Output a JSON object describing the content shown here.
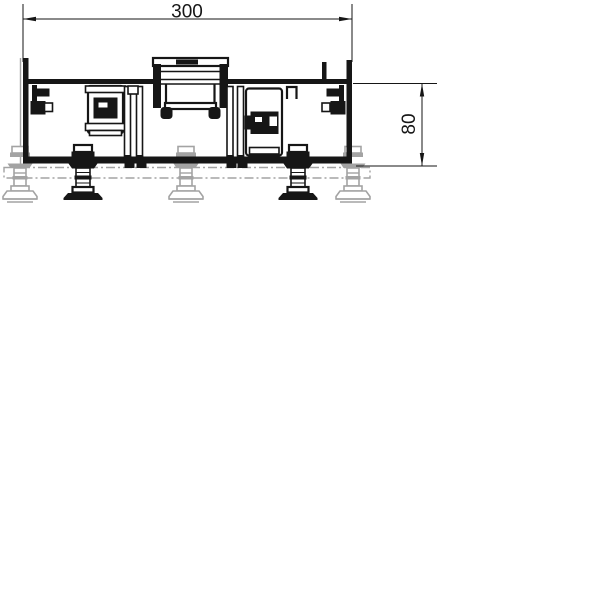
{
  "drawing": {
    "dimensions": {
      "width_label": "300",
      "height_label": "80"
    },
    "colors": {
      "line": "#161616",
      "phantom": "#a3a3a3",
      "background": "#ffffff"
    }
  }
}
